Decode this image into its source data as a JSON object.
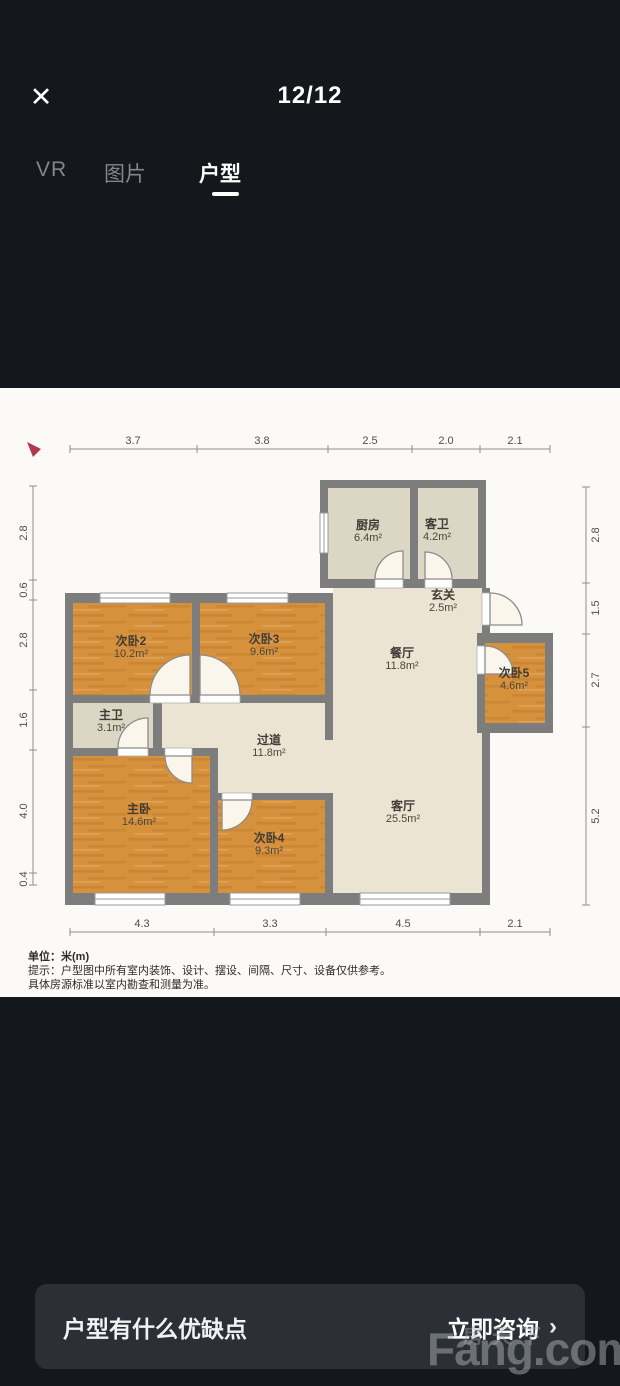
{
  "header": {
    "close_icon": "✕",
    "counter": "12/12"
  },
  "tabs": {
    "vr": "VR",
    "images": "图片",
    "floorplan": "户型"
  },
  "floorplan": {
    "rooms": [
      {
        "name": "厨房",
        "area": "6.4m²"
      },
      {
        "name": "客卫",
        "area": "4.2m²"
      },
      {
        "name": "玄关",
        "area": "2.5m²"
      },
      {
        "name": "餐厅",
        "area": "11.8m²"
      },
      {
        "name": "次卧2",
        "area": "10.2m²"
      },
      {
        "name": "次卧3",
        "area": "9.6m²"
      },
      {
        "name": "次卧5",
        "area": "4.6m²"
      },
      {
        "name": "主卫",
        "area": "3.1m²"
      },
      {
        "name": "过道",
        "area": "11.8m²"
      },
      {
        "name": "主卧",
        "area": "14.6m²"
      },
      {
        "name": "次卧4",
        "area": "9.3m²"
      },
      {
        "name": "客厅",
        "area": "25.5m²"
      }
    ],
    "dims_top": [
      "3.7",
      "3.8",
      "2.5",
      "2.0",
      "2.1"
    ],
    "dims_bottom": [
      "4.3",
      "3.3",
      "4.5",
      "2.1"
    ],
    "dims_left": [
      "2.8",
      "0.6",
      "2.8",
      "1.6",
      "4.0",
      "0.4"
    ],
    "dims_right": [
      "2.8",
      "1.5",
      "2.7",
      "5.2"
    ],
    "unit_note": "单位：米(m)",
    "disclaimer1": "提示：户型图中所有室内装饰、设计、摆设、间隔、尺寸、设备仅供参考。",
    "disclaimer2": "具体房源标准以室内勘查和测量为准。",
    "colors": {
      "wall": "#7d7d7d",
      "bedroom": "#d6913c",
      "living": "#ebe4d2",
      "bath": "#dcd6c5",
      "compass": "#b23a48"
    }
  },
  "footer": {
    "question": "户型有什么优缺点",
    "cta": "立即咨询",
    "chevron": "›"
  },
  "watermark": {
    "cn": "房天下",
    "en": "Fang.com"
  }
}
